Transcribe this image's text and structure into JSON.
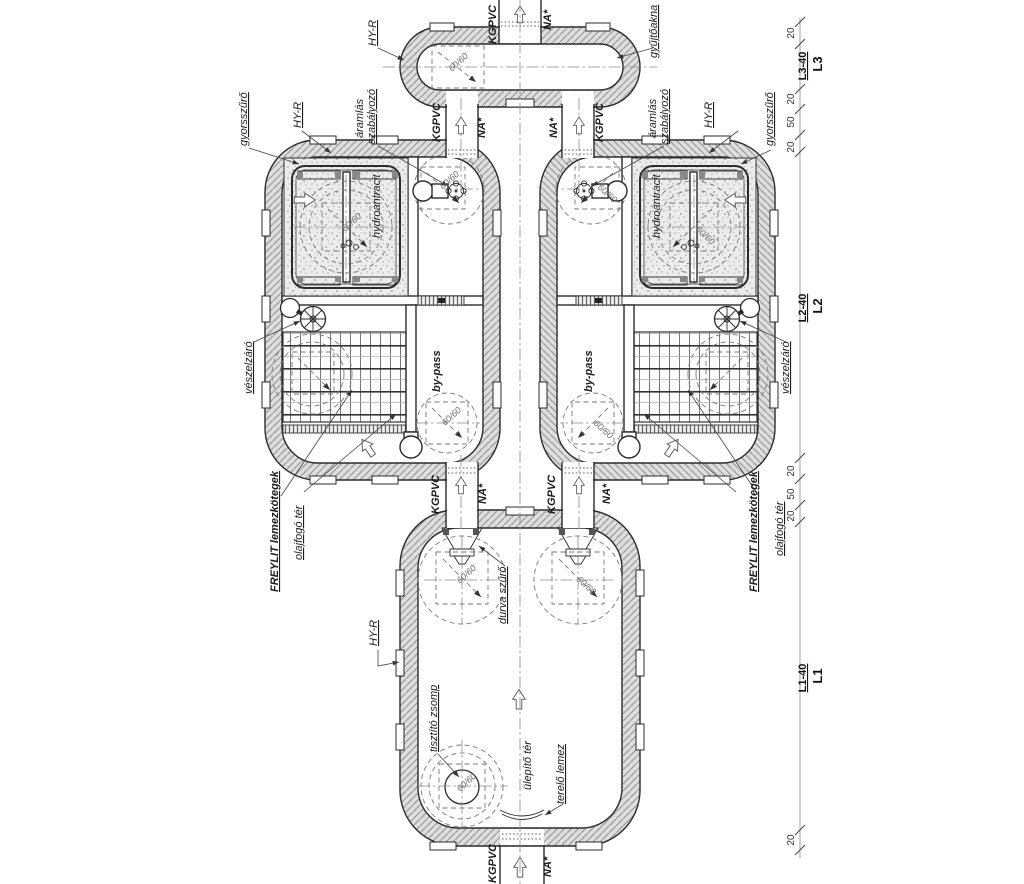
{
  "drawing": {
    "kind": "oil-separator treatment plant plan",
    "tanks": {
      "top_collection_tank": "gyűjtőakna",
      "separator_tanks": 2,
      "settling_tank": "ülepítő tér"
    }
  },
  "labels": {
    "hy_r": "HY-R",
    "kgpvc": "KGPVC",
    "na": "NA*",
    "gyujtoakna": "gyűjtőakna",
    "gyorsszuro": "gyorsszűrő",
    "aramlas_line1": "áramlás",
    "aramlas_line2": "szabályozó",
    "hydroantracit": "hydroantracit",
    "bypass": "by-pass",
    "veszelzaro": "vészelzáró",
    "freylit": "FREYLIT lemezkötegek",
    "olajfogo": "olajfogó tér",
    "durva_szuro": "durva szűrő",
    "tisztito_zsomp": "tisztító zsomp",
    "ulepito_ter": "ülepítő tér",
    "terelo_lemez": "terelő lemez",
    "manhole": "60/60"
  },
  "dimensions": {
    "d20": "20",
    "d50": "50",
    "l3": "L3-40",
    "l3_axis": "L3",
    "l2": "L2-40",
    "l2_axis": "L2",
    "l1": "L1-40",
    "l1_axis": "L1"
  },
  "colors": {
    "line": "#2b2b2b",
    "dashed": "#787878",
    "wall_fill": "#dedede",
    "hatch_line": "#9a9a9a",
    "text": "#1c1c1c"
  }
}
